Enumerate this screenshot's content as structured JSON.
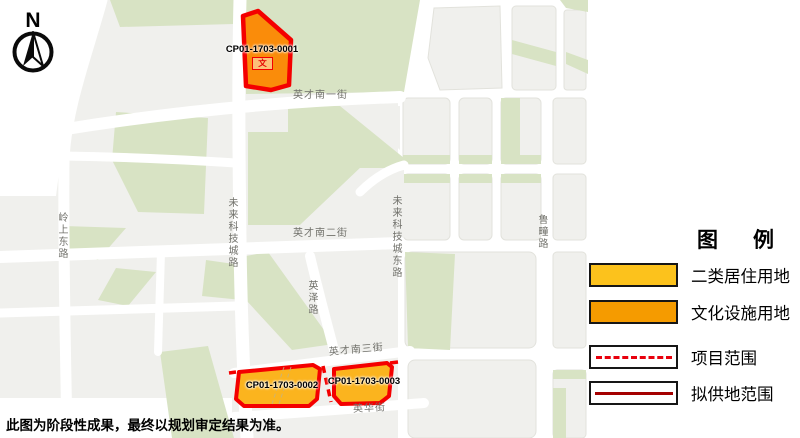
{
  "compass": {
    "label": "N"
  },
  "parcels": [
    {
      "id": "CP01-1703-0001",
      "use_tag": "文",
      "land_use": "文化设施用地"
    },
    {
      "id": "CP01-1703-0002",
      "land_use": "二类居住用地"
    },
    {
      "id": "CP01-1703-0003",
      "land_use": "二类居住用地"
    }
  ],
  "streets": [
    {
      "name": "英才南一街",
      "orientation": "horizontal"
    },
    {
      "name": "英才南二街",
      "orientation": "horizontal"
    },
    {
      "name": "英才南三街",
      "orientation": "horizontal"
    },
    {
      "name": "英华街",
      "orientation": "horizontal"
    },
    {
      "name": "未来科技城路",
      "orientation": "vertical"
    },
    {
      "name": "未来科技城东路",
      "orientation": "vertical"
    },
    {
      "name": "鲁疃路",
      "orientation": "vertical"
    },
    {
      "name": "岭上东路",
      "orientation": "vertical"
    },
    {
      "name": "英泽路",
      "orientation": "vertical"
    }
  ],
  "legend": {
    "title": "图　例",
    "items": [
      {
        "label": "二类居住用地",
        "swatch": "fill",
        "color": "#FCC21C"
      },
      {
        "label": "文化设施用地",
        "swatch": "fill",
        "color": "#F59B00"
      },
      {
        "label": "项目范围",
        "swatch": "dashed-line",
        "color": "#E8000D"
      },
      {
        "label": "拟供地范围",
        "swatch": "solid-line",
        "color": "#A40000"
      }
    ]
  },
  "footer": {
    "disclaimer": "此图为阶段性成果，最终以规划审定结果为准。"
  },
  "colors": {
    "residential_parcel": "#FBB41E",
    "culture_parcel": "#FA8C0A",
    "parcel_border_red": "#F40000",
    "green_space": "#D8E3C4",
    "block_gray": "#F0F0ED",
    "road_white": "#FFFFFF",
    "street_label_gray": "#70706A"
  }
}
